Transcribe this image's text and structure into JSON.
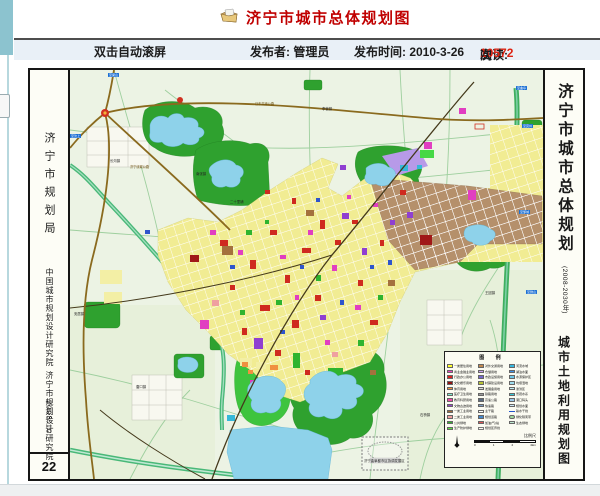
{
  "page": {
    "title": "济宁市城市总体规划图"
  },
  "meta_bar": {
    "scroll_hint": "双击自动滚屏",
    "publisher": "发布者: 管理员",
    "publish_time": "发布时间: 2010-3-26",
    "reads_label": "阅读: ",
    "reads_count": "10572",
    "reads_suffix": "次"
  },
  "map": {
    "left_panel": {
      "agency": "济宁市规划局",
      "institute_1": "中国城市规划设计研究院",
      "institute_2": "济宁市规划设计研究院",
      "date": "2008.10",
      "page_no": "22"
    },
    "right_panel": {
      "title": "济宁市城市总体规划",
      "subtitle": "(2008-2030年)",
      "map_name": "城市土地利用规划图"
    },
    "labels": [
      {
        "t": "长沟镇",
        "x": 40,
        "y": 90,
        "k": "town"
      },
      {
        "t": "南张镇",
        "x": 126,
        "y": 103,
        "k": "town"
      },
      {
        "t": "二十里铺",
        "x": 160,
        "y": 131,
        "k": "town"
      },
      {
        "t": "李营镇",
        "x": 252,
        "y": 38,
        "k": "town"
      },
      {
        "t": "安居镇",
        "x": 4,
        "y": 243,
        "k": "town"
      },
      {
        "t": "唐口镇",
        "x": 66,
        "y": 316,
        "k": "town"
      },
      {
        "t": "石桥镇",
        "x": 350,
        "y": 344,
        "k": "town"
      },
      {
        "t": "接庄镇",
        "x": 395,
        "y": 296,
        "k": "town"
      },
      {
        "t": "王因镇",
        "x": 415,
        "y": 222,
        "k": "town"
      },
      {
        "t": "日东高速公路",
        "x": 185,
        "y": 33,
        "k": "road"
      },
      {
        "t": "济宁绕城公路",
        "x": 60,
        "y": 96,
        "k": "road"
      },
      {
        "t": "至梁山",
        "x": 38,
        "y": 3,
        "k": "marker"
      },
      {
        "t": "至汶上",
        "x": 0,
        "y": 64,
        "k": "marker"
      },
      {
        "t": "至曲阜",
        "x": 446,
        "y": 16,
        "k": "marker"
      },
      {
        "t": "至兖州",
        "x": 452,
        "y": 54,
        "k": "marker"
      },
      {
        "t": "至邹城",
        "x": 449,
        "y": 140,
        "k": "marker"
      },
      {
        "t": "至微山",
        "x": 456,
        "y": 220,
        "k": "marker"
      },
      {
        "t": "济宁曲阜都市区协调发展区",
        "x": 294,
        "y": 390,
        "k": "town"
      }
    ],
    "legend": {
      "title": "图 例",
      "rows": [
        {
          "a": {
            "color": "#ffff2e",
            "label": "一类居住用地"
          },
          "b": {
            "color": "#c08850",
            "label": "对外交通用地"
          },
          "c": {
            "color": "#35b8e0",
            "label": "河流水域"
          }
        },
        {
          "a": {
            "color": "#ee3fc4",
            "label": "商业金融业用地"
          },
          "b": {
            "color": "#c9a0ef",
            "label": "仓储用地"
          },
          "c": {
            "color": "#3f8fe8",
            "label": "湖泊水面"
          }
        },
        {
          "a": {
            "color": "#d92222",
            "label": "行政办公用地"
          },
          "b": {
            "color": "#7468cc",
            "label": "市政设施用地"
          },
          "c": {
            "color": "#6fc8ea",
            "label": "水源保护区"
          }
        },
        {
          "a": {
            "color": "#8e1210",
            "label": "文化娱乐用地"
          },
          "b": {
            "color": "#b8c435",
            "label": "村镇建设用地"
          },
          "c": {
            "color": "#9fdcee",
            "label": "坑塘湿地"
          }
        },
        {
          "a": {
            "color": "#f2953f",
            "label": "体育用地"
          },
          "b": {
            "color": "#d9d9d9",
            "label": "发展备用地"
          },
          "c": {
            "color": "#c2ecf2",
            "label": "滞洪区"
          }
        },
        {
          "a": {
            "color": "#7deccc",
            "label": "医疗卫生用地"
          },
          "b": {
            "color": "#9a9a9a",
            "label": "铁路用地"
          },
          "c": {
            "color": "#37c8d8",
            "label": "景观水系"
          }
        },
        {
          "a": {
            "color": "#ef48a8",
            "label": "教育科研用地"
          },
          "b": {
            "color": "#5a6b80",
            "label": "高速公路"
          },
          "c": {
            "color": "#9cc8ea",
            "label": "港口码头"
          }
        },
        {
          "a": {
            "color": "#9a44cc",
            "label": "文物古迹用地"
          },
          "b": {
            "color": "#7e9cc0",
            "label": "快速路"
          },
          "c": {
            "color": "#cfe9f8",
            "label": "规划水面"
          }
        },
        {
          "a": {
            "color": "#a06a36",
            "label": "一类工业用地"
          },
          "b": {
            "color": "#ffffff",
            "label": "主干路"
          },
          "c": {
            "color": "line:#2255cc",
            "label": "输水干线"
          }
        },
        {
          "a": {
            "color": "#efa0a0",
            "label": "二类工业用地"
          },
          "b": {
            "color": "#4488cc",
            "label": "规划道路"
          },
          "c": {
            "color": "oval:#9fd89f",
            "label": "绿化隔离带"
          }
        },
        {
          "a": {
            "color": "#2fb42f",
            "label": "公共绿地"
          },
          "b": {
            "color": "#dd5555",
            "label": "加油(气)站"
          },
          "c": {
            "color": "#bfe8cf",
            "label": "生态绿地"
          }
        },
        {
          "a": {
            "color": "#5ae63e",
            "label": "生产防护绿地"
          },
          "b": {
            "color": "dashed",
            "label": "规划区界线"
          },
          "c": null
        }
      ],
      "scale_label": "比例尺",
      "scale_ticks": [
        "0",
        "1",
        "2",
        "4km"
      ]
    }
  }
}
